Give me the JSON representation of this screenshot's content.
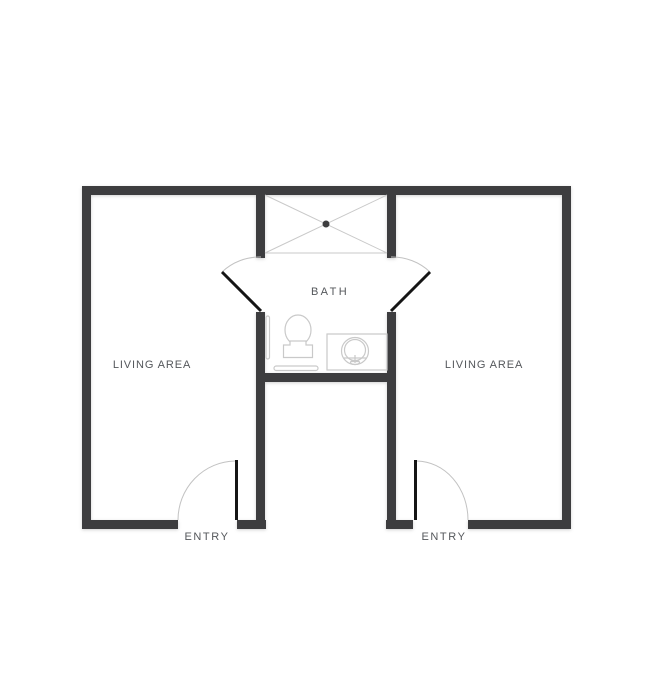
{
  "floorplan": {
    "labels": {
      "living_left": "LIVING AREA",
      "living_right": "LIVING AREA",
      "bath": "BATH",
      "entry_left": "ENTRY",
      "entry_right": "ENTRY"
    },
    "colors": {
      "background": "#ffffff",
      "wall": "#3d3d3f",
      "door_leaf": "#151515",
      "swing_arc": "#c2c2c2",
      "fixture_outline": "#c9c9c9",
      "drain": "#3d3d3f",
      "label_text": "#54575b"
    }
  }
}
